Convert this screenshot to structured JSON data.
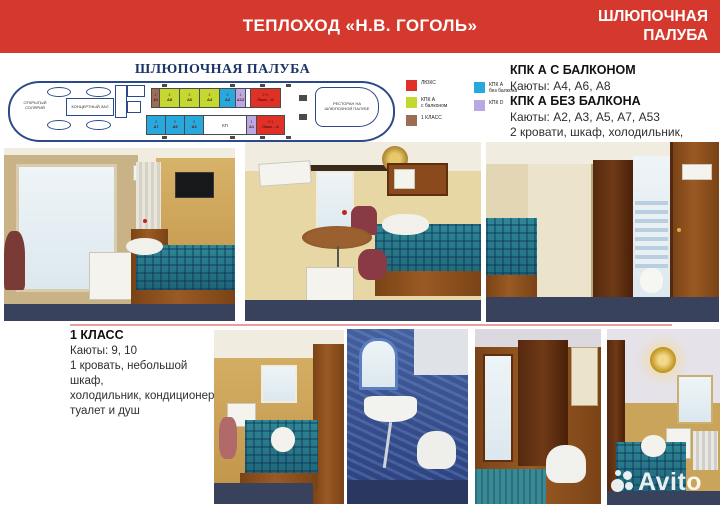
{
  "colors": {
    "header_bg": "#d5392d",
    "divider": "#e89f9e",
    "plan_outline": "#2b4a8b",
    "plan_title": "#1b3568"
  },
  "header": {
    "title": "ТЕПЛОХОД «Н.В. ГОГОЛЬ»",
    "deck_line1": "ШЛЮПОЧНАЯ",
    "deck_line2": "ПАЛУБА"
  },
  "plan": {
    "title": "ШЛЮПОЧНАЯ ПАЛУБА",
    "ship": {
      "solarium": "ОТКРЫТЫЙ СОЛЯРИЙ",
      "concert": "КОНЦЕРТНЫЙ ЗАЛ",
      "restaurant": "РЕСТОРАН НА ШЛЮПОЧНОЙ ПАЛУБЕ",
      "kp": "КП"
    },
    "type_colors": {
      "lux": "#e03127",
      "kpkA_balcony": "#c4d832",
      "first": "#9c6c54",
      "kpkA": "#29a8dd",
      "kpkD": "#b9a8e4"
    },
    "cabins_top": [
      {
        "beds": "1",
        "id": "10",
        "type": "first"
      },
      {
        "beds": "2",
        "id": "А8",
        "type": "kpkA_balcony"
      },
      {
        "beds": "2",
        "id": "А6",
        "type": "kpkA_balcony"
      },
      {
        "beds": "2",
        "id": "А4",
        "type": "kpkA_balcony"
      },
      {
        "beds": "2",
        "id": "А2",
        "type": "kpkA"
      },
      {
        "beds": "1",
        "id": "А12",
        "type": "kpkD"
      },
      {
        "beds": "2+1",
        "id": "Люкс - Б",
        "type": "lux"
      }
    ],
    "cabins_bottom": [
      {
        "beds": "2",
        "id": "А7",
        "type": "kpkA"
      },
      {
        "beds": "2",
        "id": "А5",
        "type": "kpkA"
      },
      {
        "beds": "2",
        "id": "А3",
        "type": "kpkA"
      },
      {
        "beds": "1",
        "id": "А1",
        "type": "kpkD"
      },
      {
        "beds": "2+1",
        "id": "Люкс - А",
        "type": "lux"
      }
    ],
    "legend_col1": [
      {
        "type": "lux",
        "label": "ЛЮКС"
      },
      {
        "type": "kpkA_balcony",
        "label": "КПК А\nс балконом"
      },
      {
        "type": "first",
        "label": "1 КЛАСС"
      }
    ],
    "legend_col2": [
      {
        "type": "kpkA",
        "label": "КПК А\nбез балкона"
      },
      {
        "type": "kpkD",
        "label": "КПК D"
      }
    ]
  },
  "info_right": {
    "heading1": "КПК А С БАЛКОНОМ",
    "cabins1": "Каюты: А4, А6, А8",
    "heading2": "КПК А БЕЗ БАЛКОНА",
    "cabins2": "Каюты: А2, А3, А5, А7, А53",
    "desc_line1": "2 кровати, шкаф, холодильник,",
    "desc_line2": "кондиционер, туалет и душ"
  },
  "info_first_class": {
    "heading": "1 КЛАСС",
    "cabins": "Каюты: 9, 10",
    "desc_line1": "1 кровать, небольшой шкаф,",
    "desc_line2": "холодильник, кондиционер,",
    "desc_line3": "туалет и душ"
  },
  "photos": [
    "cabin-with-balcony",
    "cabin-two-beds",
    "cabin-with-bathroom-door",
    "first-class-cabin",
    "bathroom-blue",
    "shower-room-wood",
    "cabin-with-chandelier"
  ],
  "watermark": {
    "text": "Avito"
  }
}
